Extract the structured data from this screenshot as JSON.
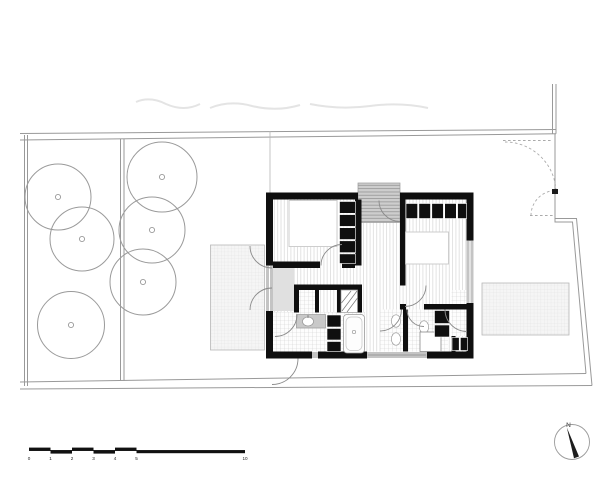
{
  "drawing": {
    "type": "architectural site and floor plan",
    "rooms": [
      "bedroom-1",
      "bedroom-2",
      "hall",
      "bathroom-1",
      "bathroom-2",
      "wc",
      "entry-stair"
    ],
    "site_features": [
      "garden-trees",
      "footpath",
      "left-terrace",
      "right-terrace",
      "driveway-gate",
      "pedestrian-gate"
    ]
  },
  "colors": {
    "wall": "#0f0f0f",
    "boundary_line": "#999999",
    "opening_gray": "#c4c4c4",
    "floor_stripe": "#dcdcdc",
    "background": "#ffffff"
  },
  "north_arrow": {
    "label": "N"
  },
  "scale_bar": {
    "labels": [
      {
        "t": "0",
        "x": 29
      },
      {
        "t": "1",
        "x": 50.5
      },
      {
        "t": "2",
        "x": 72
      },
      {
        "t": "3",
        "x": 93.5
      },
      {
        "t": "4",
        "x": 115
      },
      {
        "t": "5",
        "x": 136.5
      },
      {
        "t": "10",
        "x": 245
      }
    ]
  },
  "trees": [
    {
      "cx": 58,
      "cy": 197,
      "r": 33
    },
    {
      "cx": 82,
      "cy": 239,
      "r": 32
    },
    {
      "cx": 71,
      "cy": 325,
      "r": 33.5
    },
    {
      "cx": 162,
      "cy": 177,
      "r": 35
    },
    {
      "cx": 152,
      "cy": 230,
      "r": 33
    },
    {
      "cx": 143,
      "cy": 282,
      "r": 33
    }
  ]
}
